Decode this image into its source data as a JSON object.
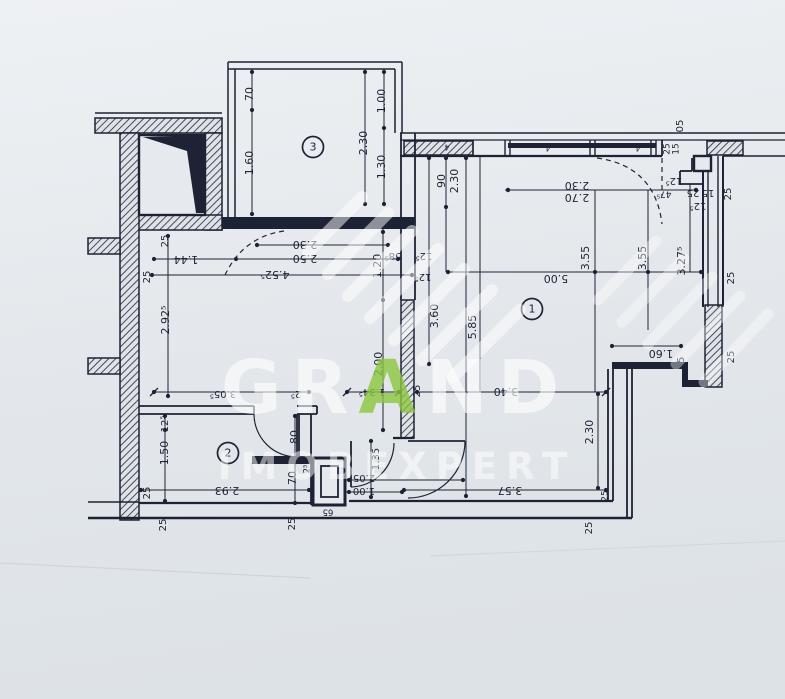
{
  "document": {
    "type": "floor-plan-scan",
    "units_note": "dimensions in meters/centimeters as printed"
  },
  "colors": {
    "ink": "#1d2334",
    "paper_top": "#edf0f3",
    "paper_bottom": "#dde2e7",
    "paper_fill": "#e6eaee",
    "watermark_white": "#ffffff",
    "watermark_green": "#8cc63f"
  },
  "watermark": {
    "brand_part1": "GR",
    "brand_accent": "A",
    "brand_part2": "ND",
    "brand_line2": "IMOBEXPERT"
  },
  "rooms": [
    {
      "n": "1",
      "x": 532,
      "y": 309
    },
    {
      "n": "2",
      "x": 228,
      "y": 453
    },
    {
      "n": "3",
      "x": 313,
      "y": 147
    }
  ],
  "labels": [
    [
      "25",
      165,
      241,
      1,
      10
    ],
    [
      "1.44",
      186,
      259,
      2,
      11
    ],
    [
      "2.30",
      305,
      244,
      2,
      11
    ],
    [
      "2.50",
      305,
      258,
      2,
      11
    ],
    [
      "4.52⁵",
      275,
      274,
      2,
      11
    ],
    [
      "25",
      147,
      277,
      1,
      10
    ],
    [
      "2.92⁵",
      166,
      320,
      1,
      11
    ],
    [
      "1.20",
      378,
      266,
      1,
      11
    ],
    [
      "58⁵",
      393,
      256,
      2,
      10
    ],
    [
      "12⁵",
      424,
      256,
      2,
      10
    ],
    [
      "12⁵",
      423,
      277,
      2,
      10
    ],
    [
      "2.00",
      379,
      364,
      1,
      11
    ],
    [
      "3.60",
      435,
      316,
      1,
      11
    ],
    [
      "5.85",
      473,
      327,
      1,
      11
    ],
    [
      "90",
      442,
      181,
      1,
      11
    ],
    [
      "2.30",
      455,
      181,
      1,
      11
    ],
    [
      "2.30",
      577,
      185,
      2,
      11
    ],
    [
      "2.70",
      577,
      197,
      2,
      11
    ],
    [
      "5.00",
      556,
      278,
      2,
      11
    ],
    [
      "3.55",
      586,
      258,
      1,
      11
    ],
    [
      "3.55",
      643,
      258,
      1,
      11
    ],
    [
      "3.27⁵",
      682,
      261,
      1,
      11
    ],
    [
      "05",
      680,
      126,
      1,
      10
    ],
    [
      "25",
      667,
      149,
      1,
      9
    ],
    [
      "15",
      676,
      149,
      1,
      9
    ],
    [
      "12⁵",
      674,
      181,
      2,
      10
    ],
    [
      "47⁵",
      664,
      194,
      2,
      9
    ],
    [
      "25",
      693,
      193,
      2,
      10
    ],
    [
      "15",
      708,
      193,
      2,
      10
    ],
    [
      "25",
      728,
      194,
      1,
      10
    ],
    [
      "12⁵",
      698,
      206,
      2,
      10
    ],
    [
      "25",
      731,
      278,
      1,
      10
    ],
    [
      "25",
      731,
      357,
      1,
      10
    ],
    [
      "1.60",
      661,
      353,
      2,
      11
    ],
    [
      "25",
      681,
      363,
      1,
      10
    ],
    [
      "2.30",
      590,
      432,
      1,
      11
    ],
    [
      "3.40",
      506,
      391,
      2,
      11
    ],
    [
      "1.34⁵",
      372,
      392,
      2,
      10
    ],
    [
      "25",
      417,
      391,
      1,
      10
    ],
    [
      "3.05⁵",
      223,
      394,
      2,
      10
    ],
    [
      "2⁵",
      296,
      394,
      2,
      10
    ],
    [
      "3.57",
      510,
      490,
      2,
      11
    ],
    [
      "2.93",
      227,
      490,
      2,
      11
    ],
    [
      "25",
      147,
      493,
      1,
      10
    ],
    [
      "1.50",
      165,
      453,
      1,
      11
    ],
    [
      "12⁵",
      165,
      424,
      1,
      10
    ],
    [
      "80",
      295,
      437,
      1,
      11
    ],
    [
      "70",
      293,
      478,
      1,
      11
    ],
    [
      "1.35",
      376,
      459,
      1,
      10
    ],
    [
      "2.05",
      364,
      478,
      2,
      10
    ],
    [
      "1.00",
      364,
      491,
      2,
      10
    ],
    [
      "25",
      163,
      525,
      1,
      10
    ],
    [
      "25",
      292,
      524,
      1,
      10
    ],
    [
      "25",
      589,
      528,
      1,
      10
    ],
    [
      "25",
      605,
      496,
      1,
      9
    ],
    [
      "70",
      250,
      94,
      1,
      11
    ],
    [
      "1.60",
      250,
      163,
      1,
      11
    ],
    [
      "1.00",
      382,
      101,
      1,
      11
    ],
    [
      "2.30",
      364,
      143,
      1,
      11
    ],
    [
      "1.30",
      382,
      167,
      1,
      11
    ],
    [
      "2⁵",
      307,
      469,
      1,
      8.5
    ],
    [
      "65",
      328,
      512,
      2,
      8.5
    ],
    [
      "4",
      447,
      147,
      2,
      8
    ],
    [
      "4",
      548,
      148,
      2,
      8
    ],
    [
      "4",
      638,
      148,
      2,
      8
    ],
    [
      "4",
      248,
      223,
      2,
      8
    ],
    [
      "4",
      378,
      222,
      2,
      8
    ]
  ]
}
